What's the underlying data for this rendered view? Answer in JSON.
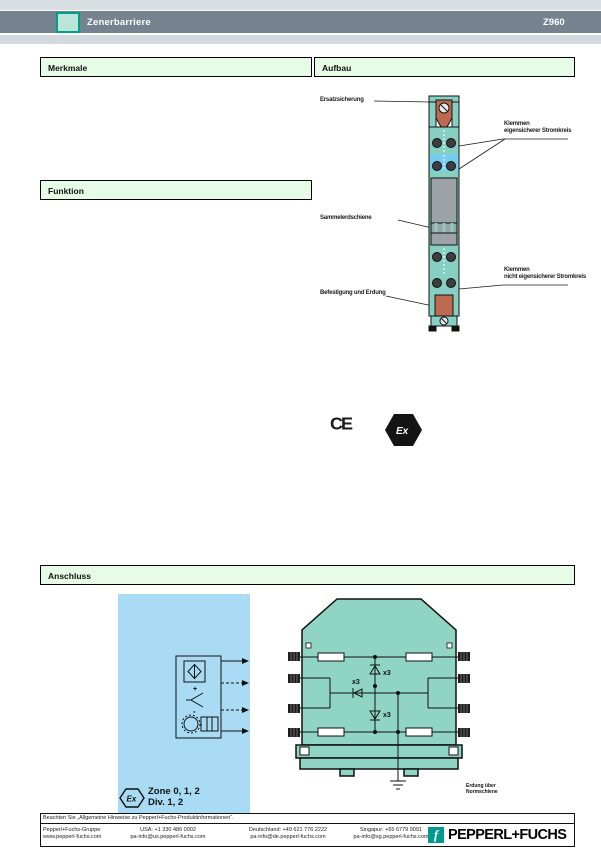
{
  "header": {
    "product": "Zenerbarriere",
    "model": "Z960"
  },
  "sections": {
    "merkmale": "Merkmale",
    "aufbau": "Aufbau",
    "funktion": "Funktion",
    "anschluss": "Anschluss"
  },
  "aufbau_figure": {
    "label_spare_fuse": "Ersatzsicherung",
    "label_is_terminals_1": "Klemmen",
    "label_is_terminals_2": "eigensicherer Stromkreis",
    "label_earth_rail": "Sammelerdschiene",
    "label_nonis_terminals_1": "Klemmen",
    "label_nonis_terminals_2": "nicht eigensicherer Stromkreis",
    "label_mounting": "Befestigung und Erdung"
  },
  "conformity": {
    "ce_mark": "CE",
    "ex_mark": "Ex"
  },
  "anschluss_figure": {
    "ex_mark": "Ex",
    "zone_line": "Zone 0, 1, 2",
    "division_line": "Div. 1, 2",
    "sensor_plus": "+",
    "sensor_minus": "-",
    "multiplier_1": "x3",
    "multiplier_2": "x3",
    "multiplier_3": "x3",
    "rail_note_1": "Erdung über",
    "rail_note_2": "Normschiene"
  },
  "footer": {
    "notice": "Beachten Sie „Allgemeine Hinweise zu Pepperl+Fuchs-Produktinformationen“.",
    "columns": [
      {
        "line1": "Pepperl+Fuchs-Gruppe",
        "line2": "www.pepperl-fuchs.com"
      },
      {
        "line1": "USA: +1 330 486 0002",
        "line2": "pa-info@us.pepperl-fuchs.com"
      },
      {
        "line1": "Deutschland: +49 621 776 2222",
        "line2": "pa-info@de.pepperl-fuchs.com"
      },
      {
        "line1": "Singapur: +65 6779 9091",
        "line2": "pa-info@sg.pepperl-fuchs.com"
      }
    ],
    "brand": "PEPPERL+FUCHS",
    "brand_glyph": "f"
  },
  "colors": {
    "accent_teal": "#00A08C",
    "header_bar": "#75828F",
    "section_green": "#E6FCE7",
    "device_teal": "#87CFC3",
    "housing_teal": "#90D4C4",
    "hazard_blue": "#A9DCF4",
    "fuse_red": "#BD6A50",
    "rail_gray": "#9DA3A6"
  }
}
